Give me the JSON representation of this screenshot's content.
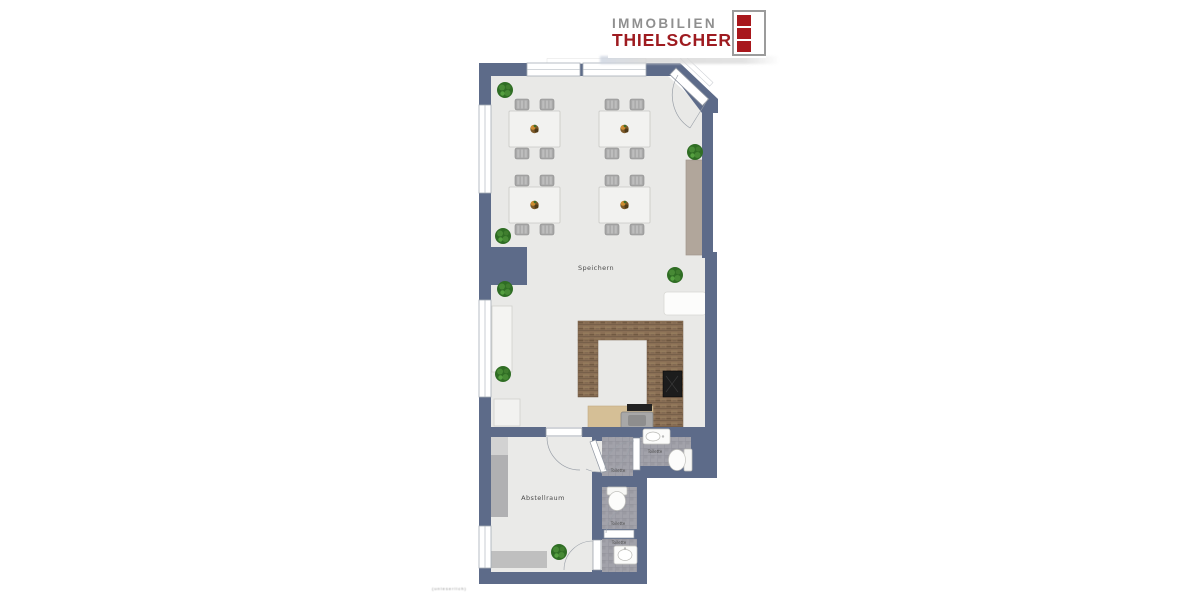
{
  "brand": {
    "name_line1": "IMMOBILIEN",
    "name_line2": "THIELSCHER",
    "text1_color": "#8f8f8f",
    "text2_color": "#9e1b20",
    "block_color": "#a8171c",
    "mark_border_color": "#9b9b9b"
  },
  "floorplan": {
    "wall_color": "#5d6b89",
    "floor_color": "#e9e9e7",
    "tile_color": "#9d9da5",
    "wood_counter_color": "#8a6f55",
    "sideboard_color": "#b1a69b",
    "plant_color": "#2f6d24",
    "labels": {
      "main_room": "Speichern",
      "storage_room": "Abstellraum",
      "wc_vestibule": "Toilette",
      "wc_right": "Toilette",
      "wc_middle": "Toilette",
      "wc_bottom": "Toilette"
    },
    "fine_print": "(unleserlich)"
  }
}
